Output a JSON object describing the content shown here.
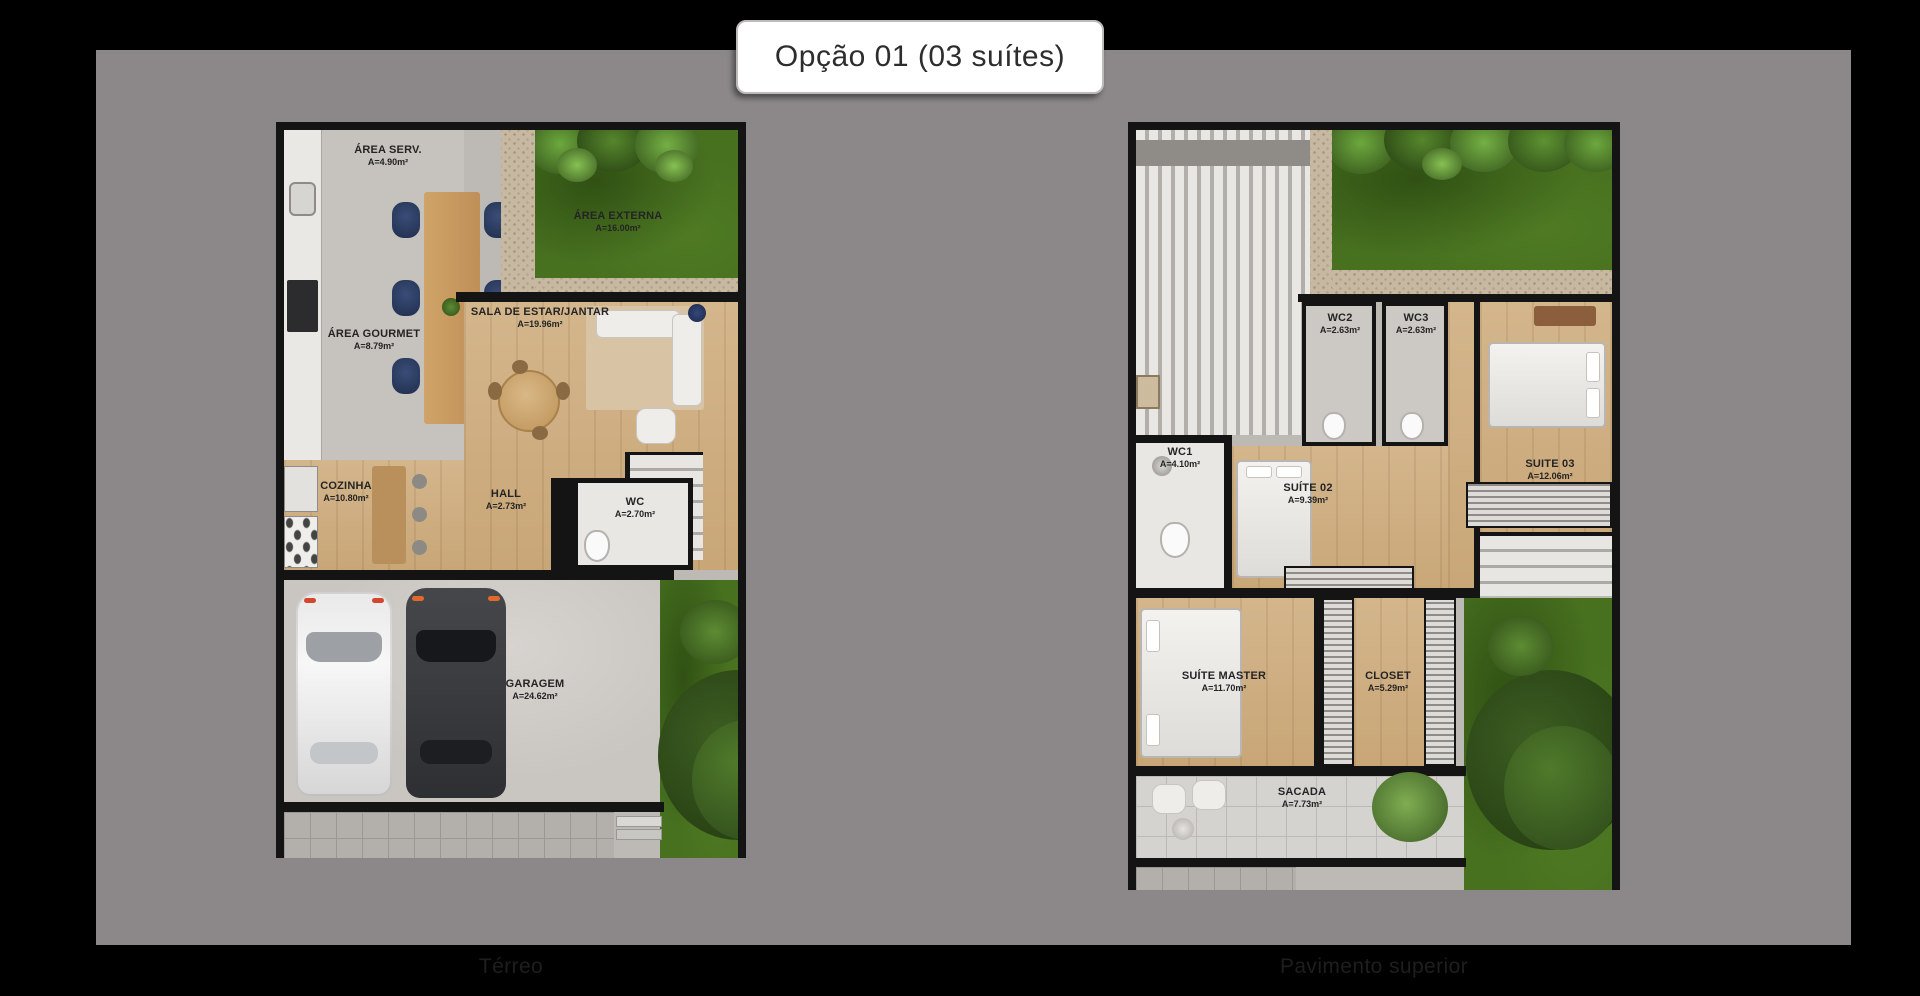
{
  "title": {
    "text": "Opção 01 (03 suítes)"
  },
  "colors": {
    "page_bg": "#000000",
    "backdrop": "#8c8889",
    "badge_bg": "#ffffff",
    "badge_text": "#2d2d2d",
    "wall": "#141414",
    "grass": "#47701f",
    "wood": "#d0b084",
    "caption_text": "#1e1e1e"
  },
  "plans": [
    {
      "id": "terreo",
      "caption": "Térreo",
      "rooms": [
        {
          "label": "ÁREA SERV.",
          "area": "A=4.90m²"
        },
        {
          "label": "ÁREA EXTERNA",
          "area": "A=16.00m²"
        },
        {
          "label": "SALA DE ESTAR/JANTAR",
          "area": "A=19.96m²"
        },
        {
          "label": "ÁREA GOURMET",
          "area": "A=8.79m²"
        },
        {
          "label": "COZINHA",
          "area": "A=10.80m²"
        },
        {
          "label": "HALL",
          "area": "A=2.73m²"
        },
        {
          "label": "WC",
          "area": "A=2.70m²"
        },
        {
          "label": "GARAGEM",
          "area": "A=24.62m²"
        }
      ]
    },
    {
      "id": "pavimento-superior",
      "caption": "Pavimento superior",
      "rooms": [
        {
          "label": "WC2",
          "area": "A=2.63m²"
        },
        {
          "label": "WC3",
          "area": "A=2.63m²"
        },
        {
          "label": "WC1",
          "area": "A=4.10m²"
        },
        {
          "label": "SUÍTE 02",
          "area": "A=9.39m²"
        },
        {
          "label": "SUITE 03",
          "area": "A=12.06m²"
        },
        {
          "label": "SUÍTE MASTER",
          "area": "A=11.70m²"
        },
        {
          "label": "CLOSET",
          "area": "A=5.29m²"
        },
        {
          "label": "SACADA",
          "area": "A=7.73m²"
        }
      ]
    }
  ]
}
